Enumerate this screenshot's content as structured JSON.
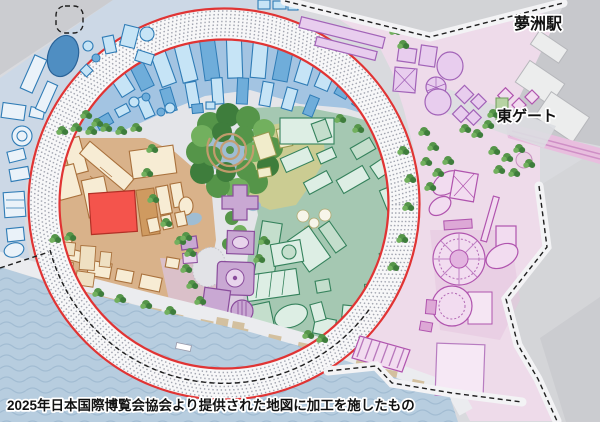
{
  "map": {
    "station_label": "夢洲駅",
    "east_gate_label": "東ゲート",
    "caption": "2025年日本国際博覧会協会より提供された地図に加工を施したもの"
  },
  "colors": {
    "land": "#d9dade",
    "land-outside": "#d4d5d8",
    "corner-gray": "#cbccd0",
    "inner-path": "#e4e5e9",
    "water": "#b7cddf",
    "wave": "#a2bcd2",
    "ring-band": "#f7f7f8",
    "ring-dot": "#a2a5b0",
    "ring-red": "#e03434",
    "blue-bg": "#a3c4e2",
    "outer-blue-bg": "#ccd8e6",
    "blue-fill": "#c6e4f6",
    "blue-dark": "#6fadda",
    "blue-stroke": "#2f7cb6",
    "outer-blue-fill": "#eaf2f9",
    "orange-bg": "#d9b28a",
    "orange-fill": "#f7ecd4",
    "orange-light": "#efe0c2",
    "orange-dark": "#cf9a60",
    "orange-stroke": "#a9713c",
    "red-building": "#f4544c",
    "red-building-stroke": "#b23026",
    "forest-dark": "#3e7d3c",
    "forest-mid": "#559549",
    "forest-light": "#72b05e",
    "pond": "#9fbdd3",
    "spiral": "#c79d6e",
    "green-bg": "#a5c8b2",
    "green-fill": "#ddeee4",
    "green-mid": "#c4decc",
    "green-stroke": "#35825c",
    "olive-bg": "#cbcc92",
    "olive-fill": "#f1eccb",
    "olive-stroke": "#98984e",
    "purple-fill": "#c9a8d3",
    "purple-light": "#e8d4ec",
    "purple-stroke": "#8a4d9c",
    "pink-bg": "#eedbea",
    "pink-plaza": "#e6c4df",
    "pink-fill": "#f2dcf0",
    "pink-mid": "#dda8d6",
    "pink-stroke": "#b054ae",
    "lavender-fill": "#e8cdee",
    "lavender-stroke": "#a263b8",
    "station-gray": "#c7c8cc",
    "station-bldg": "#eceded",
    "rails-pink": "#e8bede",
    "promenade": "#ebecef",
    "kiosk": "#d3c09f",
    "label": "#111111",
    "halo": "#ffffff"
  }
}
